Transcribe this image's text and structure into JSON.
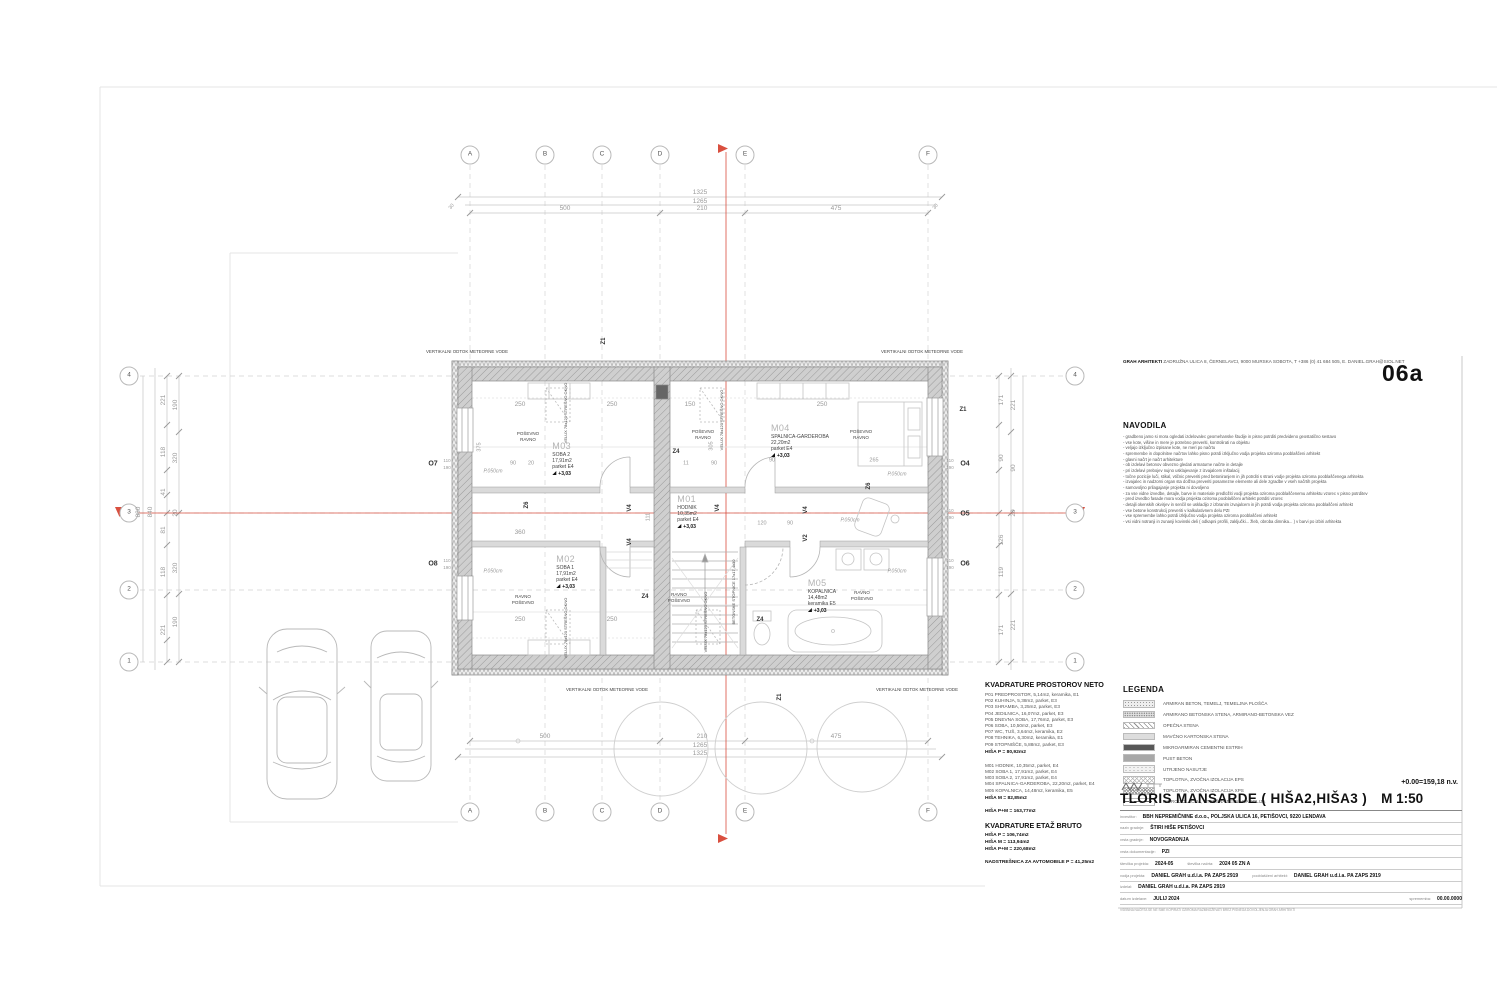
{
  "header": {
    "firm_name": "GRAH ARHITEKTI",
    "firm_rest": " ZADRUŽNA ULICA 8, ČERNELAVCI, 9000 MURSKA SOBOTA, T +386 (0) 41 684 505, E. DANIEL.GRAH@SIOL.NET",
    "sheet_code": "06a"
  },
  "navodila": {
    "title": "NAVODILA",
    "lines": [
      "gradbeno jamo si mora ogledati izdelovalec geomehanske študije in pisno potrditi predvideno geostatično sestavo",
      "vse kote, višine in mere je potrebno preveriti, kontrolirati na objektu",
      "veljajo izključno izpisane kote, ne meri po načrtu",
      "spremembe in dopolnitve načrtov lahko pisno potrdi izključno vodja projekta oziroma pooblaščeni arhitekt",
      "glavni načrt je načrt arhitekture",
      "ob izdelavi betonov obvezno gledati armaturne načrte in detajle",
      "pri izdelavi prebojev nujno usklajevanje z izvajalcem inštalacij",
      "točne pozicije luči, stikal, vtičnic preveriti pred betoniranjem in jih potrditi s strani vodje projekta oziroma pooblaščenega arhitekta",
      "izvajalec in nadzorni organ sta dolžna preveriti posamezne elemente ali dele zgradbe v vseh načrtih projekta",
      "samovoljno prilagajanje projekta ni dovoljeno",
      "za vse vidne izvedbe, detajle, barve in materiale predložiti vodji projekta oziroma pooblaščenemu arhitektu vzorec v pisno potrditev",
      "pred izvedbo fasade mora vodja projekta oziroma pooblaščeni arhitekt potrditi vzorec",
      "detajli okenskih okvirjev in senčil se uskladijo z izbranim izvajalcem in jih potrdi vodja projekta oziroma pooblaščeni arhitekt",
      "vse betone konstrukcij preveriti v kalkulativnem delu PZI",
      "vse spremembe lahko potrdi izključno vodja projekta oziroma pooblaščeni arhitekt",
      "vsi vidni notranji in zunanji kovinski deli ( odkapni profili, zaključki... žleb, obroba dimnika... ) v barvi po izbiri arhitekta"
    ]
  },
  "kvadrature": {
    "title_neto": "KVADRATURE PROSTOROV NETO",
    "neto_p": [
      "P01 PREDPROSTOR, 5,14m2, keramika, E1",
      "P02 KUHINJA, 5,38m2, parket, E3",
      "P03 SHRAMBA, 3,25m2, parket, E3",
      "P04 JEDILNICA, 16,07m2, parket, E3",
      "P05 DNEVNA SOBA, 17,76m2, parket, E3",
      "P06 SOBA, 10,50m2, parket, E3",
      "P07 WC, TUŠ, 3,64m2, keramika, E2",
      "P08 TEHNIKA, 6,30m2, keramika, E1",
      "P09 STOPNIŠČE, 5,88m2, parket, E3"
    ],
    "neto_p_total": "HIŠA P = 80,92m2",
    "neto_m": [
      "M01 HODNIK, 10,35m2, parket, E4",
      "M02 SOBA 1, 17,91m2, parket, E4",
      "M03 SOBA 2, 17,91m2, parket, E4",
      "M04 SPALNICA-GARDEROBA, 22,20m2, parket, E4",
      "M05 KOPALNICA, 14,48m2, keramika, E5"
    ],
    "neto_m_total": "HIŠA M = 82,85m2",
    "neto_total": "HIŠA P+M = 163,77m2",
    "title_bruto": "KVADRATURE ETAŽ BRUTO",
    "bruto": [
      "HIŠA P = 106,74m2",
      "HIŠA M = 113,94m2",
      "HIŠA P+M = 220,68m2"
    ],
    "carport": "NADSTREŠNICA ZA AVTOMOBILE P = 41,25m2"
  },
  "legend": {
    "title": "LEGENDA",
    "items": [
      {
        "label": "ARMIRAN BETON, TEMELJ, TEMELJNA PLOŠČA",
        "pattern": "sw-stipple"
      },
      {
        "label": "ARMIRANO BETONSKA STENA, ARMIRANO-BETONSKA VEZ",
        "pattern": "sw-stipple2"
      },
      {
        "label": "OPEČNA STENA",
        "pattern": "sw-diag"
      },
      {
        "label": "MAVČNO KARTONSKA STENA",
        "pattern": "sw-light"
      },
      {
        "label": "MIKROARMIRAN CEMENTNI ESTRIH",
        "pattern": "sw-dark"
      },
      {
        "label": "PUST BETON",
        "pattern": "sw-gray"
      },
      {
        "label": "UTRJENO NASUTJE",
        "pattern": "sw-dots"
      },
      {
        "label": "TOPLOTNA, ZVOČNA IZOLACIJA EPS",
        "pattern": "sw-cross"
      },
      {
        "label": "TOPLOTNA, ZVOČNA IZOLACIJA XPS",
        "pattern": "sw-cross2"
      },
      {
        "label": "HIDROIZOLACIJA, STREŠNA TESNILNA FOLIJA",
        "pattern": "sw-dashdot"
      }
    ]
  },
  "titleblock": {
    "elevation": "+0.00=159,18 n.v.",
    "title": "TLORIS MANSARDE ( HIŠA2,HIŠA3 )",
    "scale": "M 1:50",
    "rows": [
      {
        "label": "investitor:",
        "value": "BBH NEPREMIČNINE d.o.o., POLJSKA ULICA 16, PETIŠOVCI, 9220 LENDAVA"
      },
      {
        "label": "naziv gradnje:",
        "value": "ŠTIRI HIŠE PETIŠOVCI"
      },
      {
        "label": "vrsta gradnje:",
        "value": "NOVOGRADNJA"
      },
      {
        "label": "vrsta dokumentacije:",
        "value": "PZI"
      },
      {
        "label": "številka projekta:",
        "value": "2024-05",
        "label2": "številka načrta:",
        "value2": "2024 05 ZN A"
      },
      {
        "label": "vodja projekta:",
        "value": "DANIEL GRAH u.d.i.a. PA ZAPS 2919",
        "label2": "pooblaščeni arhitekt:",
        "value2": "DANIEL GRAH u.d.i.a. PA ZAPS 2919"
      },
      {
        "label": "izdelal:",
        "value": "DANIEL GRAH u.d.i.a. PA ZAPS 2919"
      },
      {
        "label": "datum izdelave:",
        "value": "JULIJ 2024",
        "label2": "sprememba:",
        "value2": "00.00.0000",
        "push2": true
      }
    ],
    "footer": "VSEBINA NAČRTA SE NE SME KOPIRATI OZIROMA RAZMNOŽEVATI BREZ PISNEGA DOVOLJENJA GRAH ARHITEKTI"
  },
  "plan": {
    "rooms": [
      {
        "code": "M03",
        "name": "SOBA 2",
        "area": "17,91m2",
        "floor": "parket E4",
        "level": "+3,03",
        "x": 563,
        "y": 441
      },
      {
        "code": "M02",
        "name": "SOBA 1",
        "area": "17,91m2",
        "floor": "parket E4",
        "level": "+3,03",
        "x": 567,
        "y": 554
      },
      {
        "code": "M01",
        "name": "HODNIK",
        "area": "10,35m2",
        "floor": "parket E4",
        "level": "+3,03",
        "x": 688,
        "y": 494
      },
      {
        "code": "M04",
        "name": "SPALNICA-GARDEROBA",
        "area": "22,20m2",
        "floor": "parket E4",
        "level": "+3,03",
        "x": 800,
        "y": 423
      },
      {
        "code": "M05",
        "name": "KOPALNICA",
        "area": "14,48m2",
        "floor": "keramika E5",
        "level": "+3,03",
        "x": 822,
        "y": 578
      }
    ],
    "annotations": [
      {
        "t": "A",
        "x": 470,
        "y": 155,
        "bub": true
      },
      {
        "t": "B",
        "x": 545,
        "y": 155,
        "bub": true
      },
      {
        "t": "C",
        "x": 602,
        "y": 155,
        "bub": true
      },
      {
        "t": "D",
        "x": 660,
        "y": 155,
        "bub": true
      },
      {
        "t": "E",
        "x": 745,
        "y": 155,
        "bub": true
      },
      {
        "t": "F",
        "x": 928,
        "y": 155,
        "bub": true
      },
      {
        "t": "A",
        "x": 470,
        "y": 812,
        "bub": true
      },
      {
        "t": "B",
        "x": 545,
        "y": 812,
        "bub": true
      },
      {
        "t": "C",
        "x": 602,
        "y": 812,
        "bub": true
      },
      {
        "t": "D",
        "x": 660,
        "y": 812,
        "bub": true
      },
      {
        "t": "E",
        "x": 745,
        "y": 812,
        "bub": true
      },
      {
        "t": "F",
        "x": 928,
        "y": 812,
        "bub": true
      },
      {
        "t": "4",
        "x": 129,
        "y": 376,
        "bub": true
      },
      {
        "t": "3",
        "x": 129,
        "y": 513,
        "bub": true
      },
      {
        "t": "2",
        "x": 129,
        "y": 590,
        "bub": true
      },
      {
        "t": "1",
        "x": 129,
        "y": 662,
        "bub": true
      },
      {
        "t": "4",
        "x": 1075,
        "y": 376,
        "bub": true
      },
      {
        "t": "3",
        "x": 1075,
        "y": 513,
        "bub": true
      },
      {
        "t": "2",
        "x": 1075,
        "y": 590,
        "bub": true
      },
      {
        "t": "1",
        "x": 1075,
        "y": 662,
        "bub": true
      },
      {
        "t": "1325",
        "x": 700,
        "y": 193
      },
      {
        "t": "1265",
        "x": 700,
        "y": 202
      },
      {
        "t": "500",
        "x": 565,
        "y": 209
      },
      {
        "t": "210",
        "x": 702,
        "y": 209
      },
      {
        "t": "475",
        "x": 836,
        "y": 209
      },
      {
        "t": "30",
        "x": 452,
        "y": 207,
        "r": -50,
        "s": 5
      },
      {
        "t": "30",
        "x": 936,
        "y": 207,
        "r": -50,
        "s": 5
      },
      {
        "t": "500",
        "x": 545,
        "y": 737
      },
      {
        "t": "210",
        "x": 702,
        "y": 737
      },
      {
        "t": "475",
        "x": 836,
        "y": 737
      },
      {
        "t": "1265",
        "x": 700,
        "y": 746
      },
      {
        "t": "1325",
        "x": 700,
        "y": 754
      },
      {
        "t": "880",
        "x": 139,
        "y": 512,
        "r": -90
      },
      {
        "t": "840",
        "x": 151,
        "y": 512,
        "r": -90
      },
      {
        "t": "221",
        "x": 164,
        "y": 400,
        "r": -90
      },
      {
        "t": "118",
        "x": 164,
        "y": 452,
        "r": -90
      },
      {
        "t": "41",
        "x": 164,
        "y": 492,
        "r": -90
      },
      {
        "t": "81",
        "x": 164,
        "y": 530,
        "r": -90
      },
      {
        "t": "118",
        "x": 164,
        "y": 572,
        "r": -90
      },
      {
        "t": "221",
        "x": 164,
        "y": 630,
        "r": -90
      },
      {
        "t": "190",
        "x": 176,
        "y": 405,
        "r": -90
      },
      {
        "t": "320",
        "x": 176,
        "y": 458,
        "r": -90
      },
      {
        "t": "20",
        "x": 176,
        "y": 513,
        "r": -90
      },
      {
        "t": "320",
        "x": 176,
        "y": 568,
        "r": -90
      },
      {
        "t": "190",
        "x": 176,
        "y": 622,
        "r": -90
      },
      {
        "t": "171",
        "x": 1002,
        "y": 400,
        "r": -90
      },
      {
        "t": "90",
        "x": 1002,
        "y": 458,
        "r": -90
      },
      {
        "t": "126",
        "x": 1002,
        "y": 540,
        "r": -90
      },
      {
        "t": "119",
        "x": 1002,
        "y": 572,
        "r": -90
      },
      {
        "t": "171",
        "x": 1002,
        "y": 630,
        "r": -90
      },
      {
        "t": "221",
        "x": 1014,
        "y": 405,
        "r": -90
      },
      {
        "t": "90",
        "x": 1014,
        "y": 468,
        "r": -90
      },
      {
        "t": "20",
        "x": 1014,
        "y": 513,
        "r": -90
      },
      {
        "t": "221",
        "x": 1014,
        "y": 625,
        "r": -90
      },
      {
        "t": "250",
        "x": 520,
        "y": 405
      },
      {
        "t": "250",
        "x": 612,
        "y": 405
      },
      {
        "t": "150",
        "x": 690,
        "y": 405
      },
      {
        "t": "250",
        "x": 822,
        "y": 405
      },
      {
        "t": "90",
        "x": 513,
        "y": 464,
        "s": 5.5
      },
      {
        "t": "20",
        "x": 531,
        "y": 464,
        "s": 5.5
      },
      {
        "t": "11",
        "x": 686,
        "y": 464,
        "s": 5.5
      },
      {
        "t": "90",
        "x": 714,
        "y": 464,
        "s": 5.5
      },
      {
        "t": "90",
        "x": 772,
        "y": 461,
        "s": 5.5
      },
      {
        "t": "265",
        "x": 874,
        "y": 461,
        "s": 5.5
      },
      {
        "t": "360",
        "x": 520,
        "y": 533
      },
      {
        "t": "375",
        "x": 480,
        "y": 447,
        "r": -90,
        "s": 5.5
      },
      {
        "t": "305",
        "x": 712,
        "y": 446,
        "r": -90,
        "s": 5.5
      },
      {
        "t": "111",
        "x": 649,
        "y": 517,
        "r": -90,
        "s": 5.5
      },
      {
        "t": "250",
        "x": 520,
        "y": 620
      },
      {
        "t": "250",
        "x": 612,
        "y": 620
      },
      {
        "t": "120",
        "x": 762,
        "y": 524,
        "s": 5.5
      },
      {
        "t": "90",
        "x": 790,
        "y": 524,
        "s": 5.5
      },
      {
        "t": "110",
        "x": 447,
        "y": 461,
        "s": 4.5
      },
      {
        "t": "190",
        "x": 447,
        "y": 468,
        "s": 4.5
      },
      {
        "t": "110",
        "x": 447,
        "y": 561,
        "s": 4.5
      },
      {
        "t": "190",
        "x": 447,
        "y": 568,
        "s": 4.5
      },
      {
        "t": "110",
        "x": 950,
        "y": 461,
        "s": 4.5
      },
      {
        "t": "190",
        "x": 950,
        "y": 468,
        "s": 4.5
      },
      {
        "t": "110",
        "x": 950,
        "y": 511,
        "s": 4.5
      },
      {
        "t": "190",
        "x": 950,
        "y": 518,
        "s": 4.5
      },
      {
        "t": "110",
        "x": 950,
        "y": 561,
        "s": 4.5
      },
      {
        "t": "190",
        "x": 950,
        "y": 568,
        "s": 4.5
      },
      {
        "t": "O7",
        "x": 433,
        "y": 464,
        "b": true,
        "c": "#333",
        "s": 7
      },
      {
        "t": "O8",
        "x": 433,
        "y": 564,
        "b": true,
        "c": "#333",
        "s": 7
      },
      {
        "t": "O4",
        "x": 965,
        "y": 464,
        "b": true,
        "c": "#333",
        "s": 7
      },
      {
        "t": "O5",
        "x": 965,
        "y": 514,
        "b": true,
        "c": "#333",
        "s": 7
      },
      {
        "t": "O6",
        "x": 965,
        "y": 564,
        "b": true,
        "c": "#333",
        "s": 7
      },
      {
        "t": "Z1",
        "x": 604,
        "y": 341,
        "r": -90,
        "c": "#333",
        "s": 6,
        "b": true
      },
      {
        "t": "Z1",
        "x": 963,
        "y": 410,
        "c": "#333",
        "s": 6,
        "b": true
      },
      {
        "t": "Z1",
        "x": 780,
        "y": 697,
        "r": -90,
        "c": "#333",
        "s": 6,
        "b": true
      },
      {
        "t": "Z4",
        "x": 676,
        "y": 452,
        "c": "#333",
        "s": 6,
        "b": true
      },
      {
        "t": "Z4",
        "x": 645,
        "y": 597,
        "c": "#333",
        "s": 6,
        "b": true
      },
      {
        "t": "Z4",
        "x": 760,
        "y": 620,
        "c": "#333",
        "s": 6,
        "b": true
      },
      {
        "t": "Z6",
        "x": 527,
        "y": 505,
        "r": -90,
        "c": "#333",
        "s": 6,
        "b": true
      },
      {
        "t": "Z6",
        "x": 869,
        "y": 486,
        "r": -90,
        "c": "#333",
        "s": 6,
        "b": true
      },
      {
        "t": "V4",
        "x": 630,
        "y": 508,
        "r": -90,
        "c": "#333",
        "s": 6,
        "b": true
      },
      {
        "t": "V4",
        "x": 630,
        "y": 542,
        "r": -90,
        "c": "#333",
        "s": 6,
        "b": true
      },
      {
        "t": "V4",
        "x": 718,
        "y": 508,
        "r": -90,
        "c": "#333",
        "s": 6,
        "b": true
      },
      {
        "t": "V4",
        "x": 806,
        "y": 510,
        "r": -90,
        "c": "#333",
        "s": 6,
        "b": true
      },
      {
        "t": "V2",
        "x": 806,
        "y": 538,
        "r": -90,
        "c": "#333",
        "s": 6,
        "b": true
      },
      {
        "t": "VERTIKALNI ODTOK METEORNE VODE",
        "x": 467,
        "y": 352,
        "c": "#444",
        "s": 4.4
      },
      {
        "t": "VERTIKALNI ODTOK METEORNE VODE",
        "x": 922,
        "y": 352,
        "c": "#444",
        "s": 4.4
      },
      {
        "t": "VERTIKALNI ODTOK METEORNE VODE",
        "x": 607,
        "y": 690,
        "c": "#444",
        "s": 4.4
      },
      {
        "t": "VERTIKALNI ODTOK METEORNE VODE",
        "x": 917,
        "y": 690,
        "c": "#444",
        "s": 4.4
      },
      {
        "t": "P.050cm",
        "x": 493,
        "y": 472,
        "i": true,
        "s": 5
      },
      {
        "t": "P.050cm",
        "x": 493,
        "y": 572,
        "i": true,
        "s": 5
      },
      {
        "t": "P.050cm",
        "x": 897,
        "y": 475,
        "i": true,
        "s": 5
      },
      {
        "t": "P.050cm",
        "x": 897,
        "y": 572,
        "i": true,
        "s": 5
      },
      {
        "t": "P.050cm",
        "x": 850,
        "y": 521,
        "i": true,
        "s": 5
      },
      {
        "t": "VELUX 78x120 STREŠNO OKNO",
        "x": 566,
        "y": 413,
        "r": -90,
        "c": "#444",
        "s": 4
      },
      {
        "t": "VELUX 78x120 STREŠNO OKNO",
        "x": 722,
        "y": 420,
        "r": -90,
        "c": "#444",
        "s": 4
      },
      {
        "t": "VELUX 78x120 STREŠNO OKNO",
        "x": 566,
        "y": 628,
        "r": -90,
        "c": "#444",
        "s": 4
      },
      {
        "t": "VELUX 78x120 STREŠNO OKNO",
        "x": 706,
        "y": 622,
        "r": -90,
        "c": "#444",
        "s": 4
      },
      {
        "t": "BETONSKE STOPNICE 17x17,4x30",
        "x": 734,
        "y": 592,
        "r": -90,
        "c": "#444",
        "s": 4
      },
      {
        "t": "POŠEVNO",
        "x": 528,
        "y": 434,
        "c": "#444",
        "s": 4.5
      },
      {
        "t": "RAVNO",
        "x": 528,
        "y": 440,
        "c": "#444",
        "s": 4.5
      },
      {
        "t": "POŠEVNO",
        "x": 703,
        "y": 432,
        "c": "#444",
        "s": 4.5
      },
      {
        "t": "RAVNO",
        "x": 703,
        "y": 438,
        "c": "#444",
        "s": 4.5
      },
      {
        "t": "POŠEVNO",
        "x": 861,
        "y": 432,
        "c": "#444",
        "s": 4.5
      },
      {
        "t": "RAVNO",
        "x": 861,
        "y": 438,
        "c": "#444",
        "s": 4.5
      },
      {
        "t": "RAVNO",
        "x": 523,
        "y": 597,
        "c": "#444",
        "s": 4.5
      },
      {
        "t": "POŠEVNO",
        "x": 523,
        "y": 603,
        "c": "#444",
        "s": 4.5
      },
      {
        "t": "RAVNO",
        "x": 679,
        "y": 595,
        "c": "#444",
        "s": 4.5
      },
      {
        "t": "POŠEVNO",
        "x": 679,
        "y": 601,
        "c": "#444",
        "s": 4.5
      },
      {
        "t": "RAVNO",
        "x": 862,
        "y": 593,
        "c": "#444",
        "s": 4.5
      },
      {
        "t": "POŠEVNO",
        "x": 862,
        "y": 599,
        "c": "#444",
        "s": 4.5
      }
    ]
  }
}
